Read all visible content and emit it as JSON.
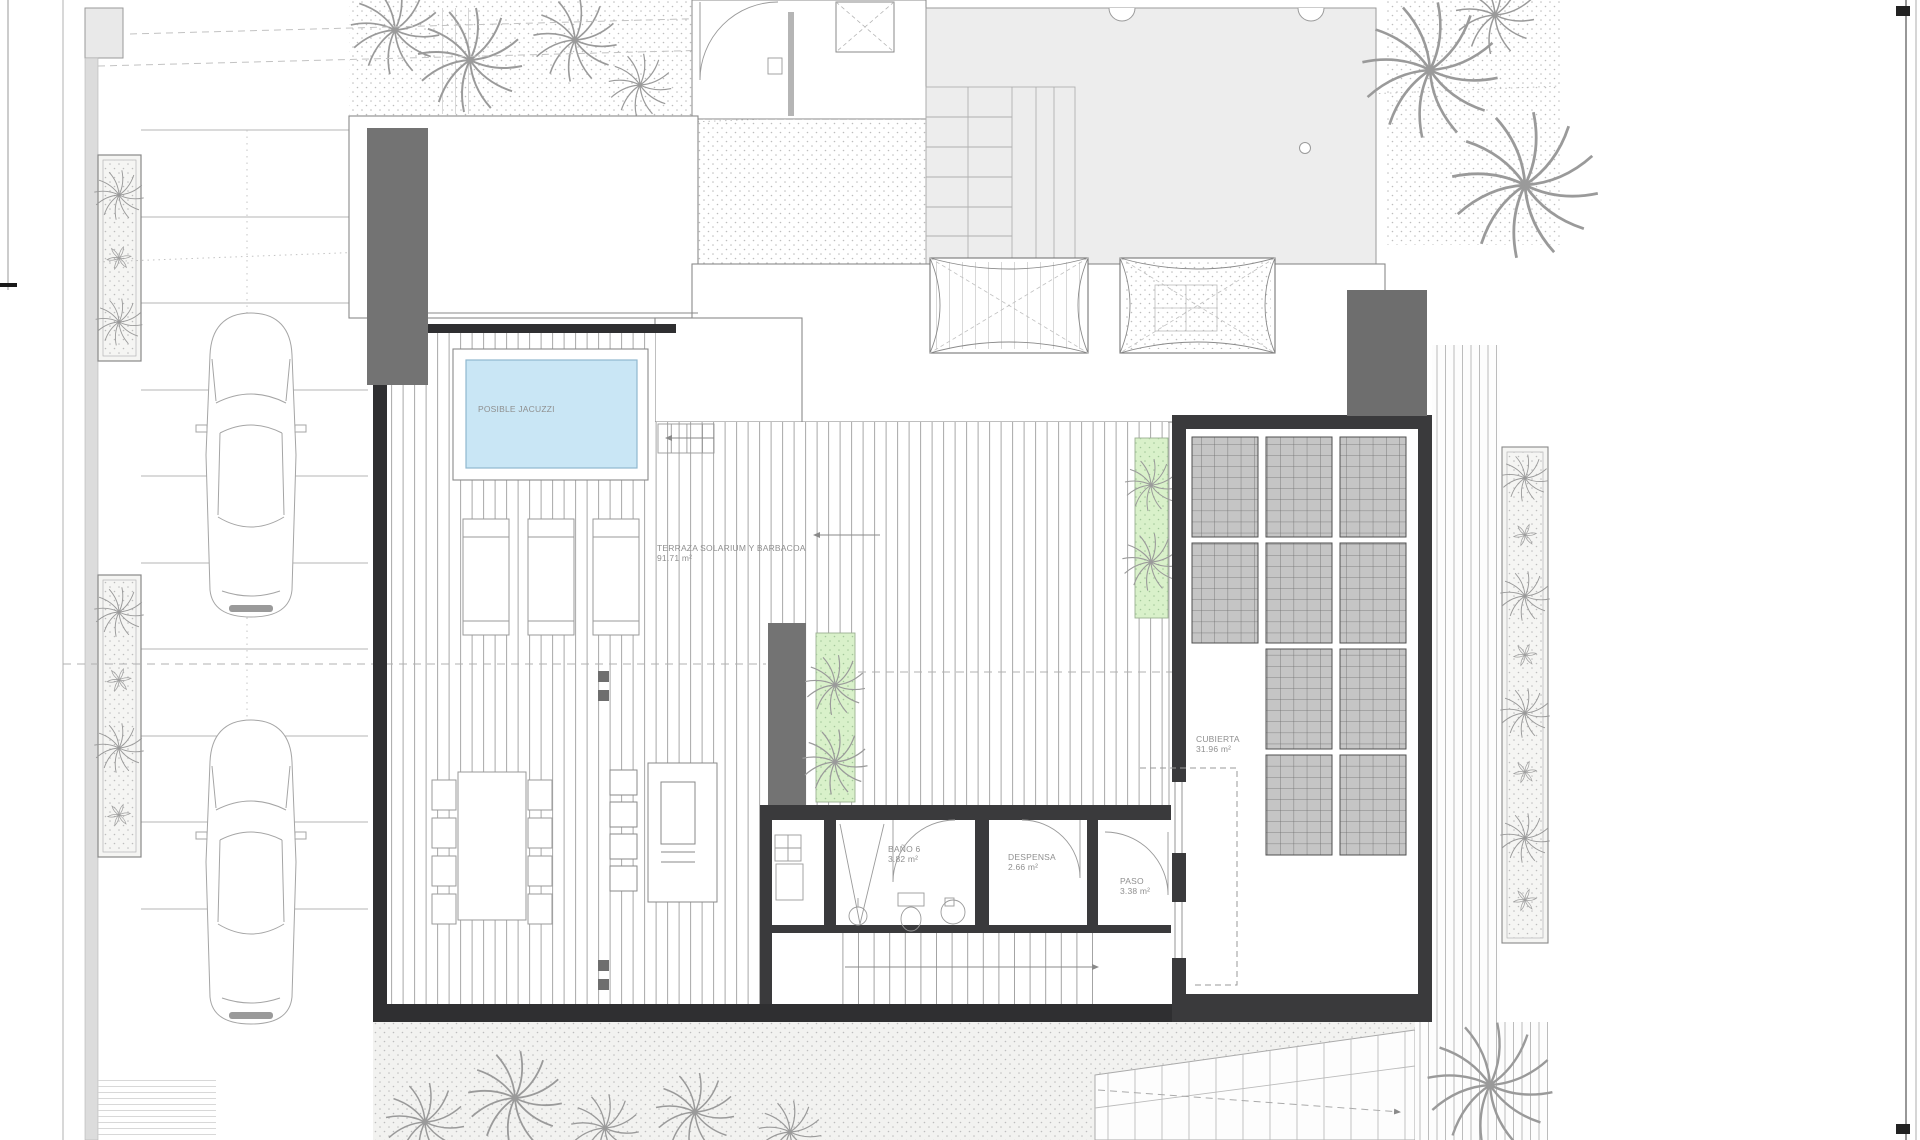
{
  "drawing": {
    "type": "architectural roof / terrace floor plan",
    "labels": {
      "jacuzzi": {
        "text": "POSIBLE JACUZZI"
      },
      "terraza": {
        "name": "TERRAZA SOLARIUM Y BARBACOA",
        "area": "91.71 m²"
      },
      "bano6": {
        "name": "BAÑO 6",
        "area": "3.82 m²"
      },
      "despensa": {
        "name": "DESPENSA",
        "area": "2.66 m²"
      },
      "paso": {
        "name": "PASO",
        "area": "3.38 m²"
      },
      "cubierta": {
        "name": "CUBIERTA",
        "area": "31.96 m²"
      }
    },
    "colors": {
      "pool_blue": "#c9e6f5",
      "planter_green": "#d9f1ca",
      "wall_dark": "#3a3a3c",
      "block_gray": "#737373",
      "panel_gray": "#c5c5c5",
      "roof_gray": "#ededed",
      "line_gray": "#9a9a9a"
    }
  }
}
